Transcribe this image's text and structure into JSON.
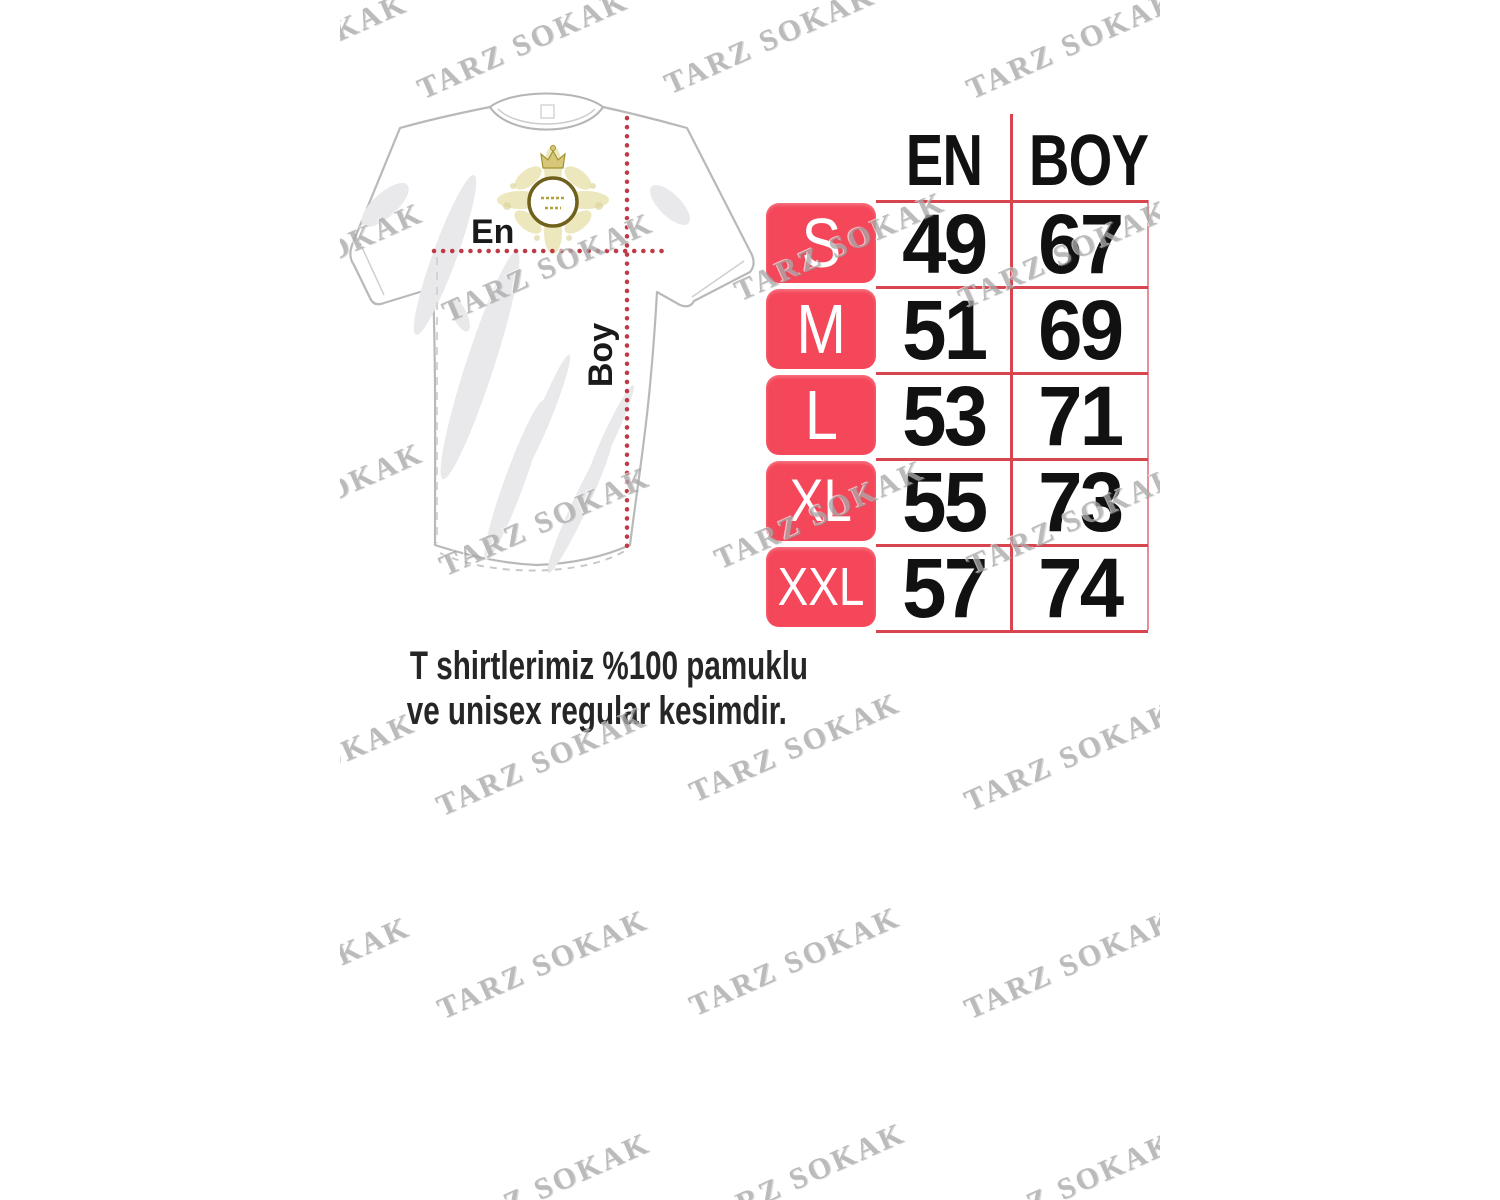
{
  "watermark": {
    "text": "TARZ SOKAK"
  },
  "diagram": {
    "width_label": "En",
    "length_label": "Boy",
    "emblem": "gold-crest-logo"
  },
  "size_table": {
    "columns": {
      "width": "EN",
      "length": "BOY"
    },
    "rows": [
      {
        "size": "S",
        "en": "49",
        "boy": "67"
      },
      {
        "size": "M",
        "en": "51",
        "boy": "69"
      },
      {
        "size": "L",
        "en": "53",
        "boy": "71"
      },
      {
        "size": "XL",
        "en": "55",
        "boy": "73"
      },
      {
        "size": "XXL",
        "en": "57",
        "boy": "74"
      }
    ]
  },
  "note": {
    "line1": "T shirtlerimiz %100 pamuklu",
    "line2": "ve unisex regular kesimdir."
  },
  "colors": {
    "chip_red": "#f4485a",
    "grid_red": "#d8454f",
    "dotted_red": "#bf3a46",
    "watermark_gray": "#a9a9a9",
    "ink": "#141414",
    "emblem_gold": "#cdbf6a"
  }
}
